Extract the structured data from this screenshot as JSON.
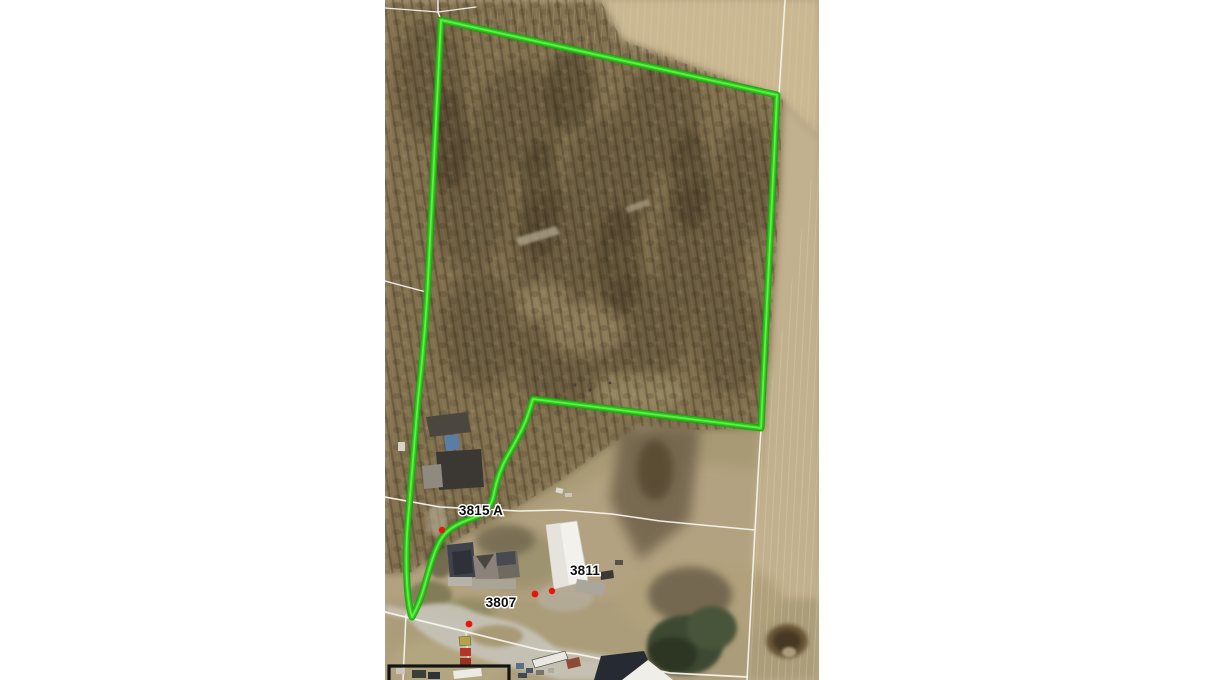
{
  "map": {
    "type": "aerial-parcel-map",
    "parcel_labels": [
      {
        "text": "3815 A",
        "x": 481,
        "y": 515
      },
      {
        "text": "3811",
        "x": 585,
        "y": 575
      },
      {
        "text": "3807",
        "x": 501,
        "y": 607
      }
    ],
    "markers": [
      {
        "x": 442,
        "y": 530
      },
      {
        "x": 535,
        "y": 594
      },
      {
        "x": 552,
        "y": 591
      },
      {
        "x": 469,
        "y": 624
      }
    ],
    "colors": {
      "parcel_highlight_green": "#2cc91a",
      "parcel_highlight_edge": "#1da50f",
      "parcel_highlight_core": "#66ef50",
      "parcel_line_white": "#f6f4ee",
      "marker_red": "#e8150a",
      "building_outline_black": "#141414"
    }
  }
}
